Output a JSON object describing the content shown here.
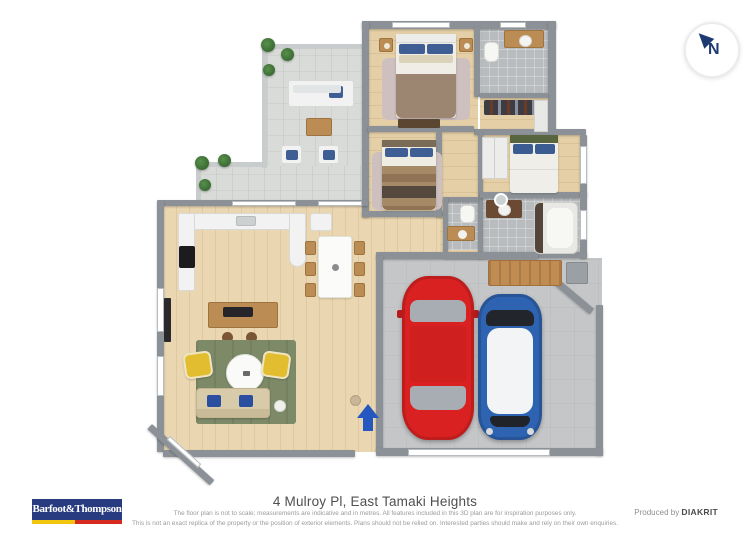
{
  "compass": {
    "letter": "N"
  },
  "footer": {
    "logo_text": "Barfoot&Thompson",
    "address": "4 Mulroy Pl, East Tamaki Heights",
    "disclaimer_line1": "The floor plan is not to scale; measurements are indicative and in metres. All features included in this 3D plan are for inspiration purposes only.",
    "disclaimer_line2": "This is not an exact replica of the property or the position of exterior elements. Plans should not be relied on. Interested parties should make and rely on their own enquiries.",
    "produced_by_label": "Produced by ",
    "producer_name": "DIAKRIT"
  },
  "colors": {
    "brand_blue": "#283a80",
    "brand_yellow": "#f2c50e",
    "brand_red": "#d52b1e",
    "compass_navy": "#1e3a72",
    "entry_arrow": "#2458c0",
    "wall_gray": "#8b9196",
    "wood_floor": "#ead7b1",
    "tile_gray": "#b8bcbe",
    "deck_gray": "#d9dbd9",
    "red_car": "#d92121",
    "blue_car": "#2e63b2",
    "rug_green": "#7d8a68",
    "armchair_yellow": "#e2bd2f",
    "pillow_blue": "#3f5f94"
  }
}
